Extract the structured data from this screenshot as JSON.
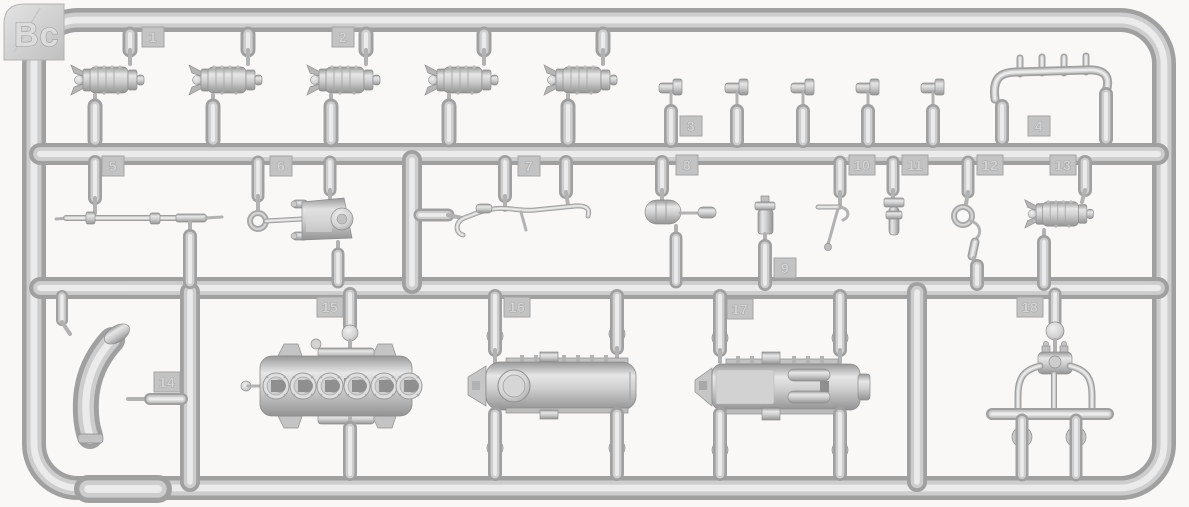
{
  "sprue": {
    "id": "Bc",
    "plastic_color": "#cbcbcb",
    "background_color": "#f9f8f7",
    "tag_color": "#c3c3c3",
    "part_labels": [
      "1",
      "2",
      "3",
      "4",
      "5",
      "6",
      "7",
      "8",
      "9",
      "10",
      "11",
      "12",
      "13",
      "14",
      "15",
      "16",
      "17",
      "18"
    ]
  }
}
